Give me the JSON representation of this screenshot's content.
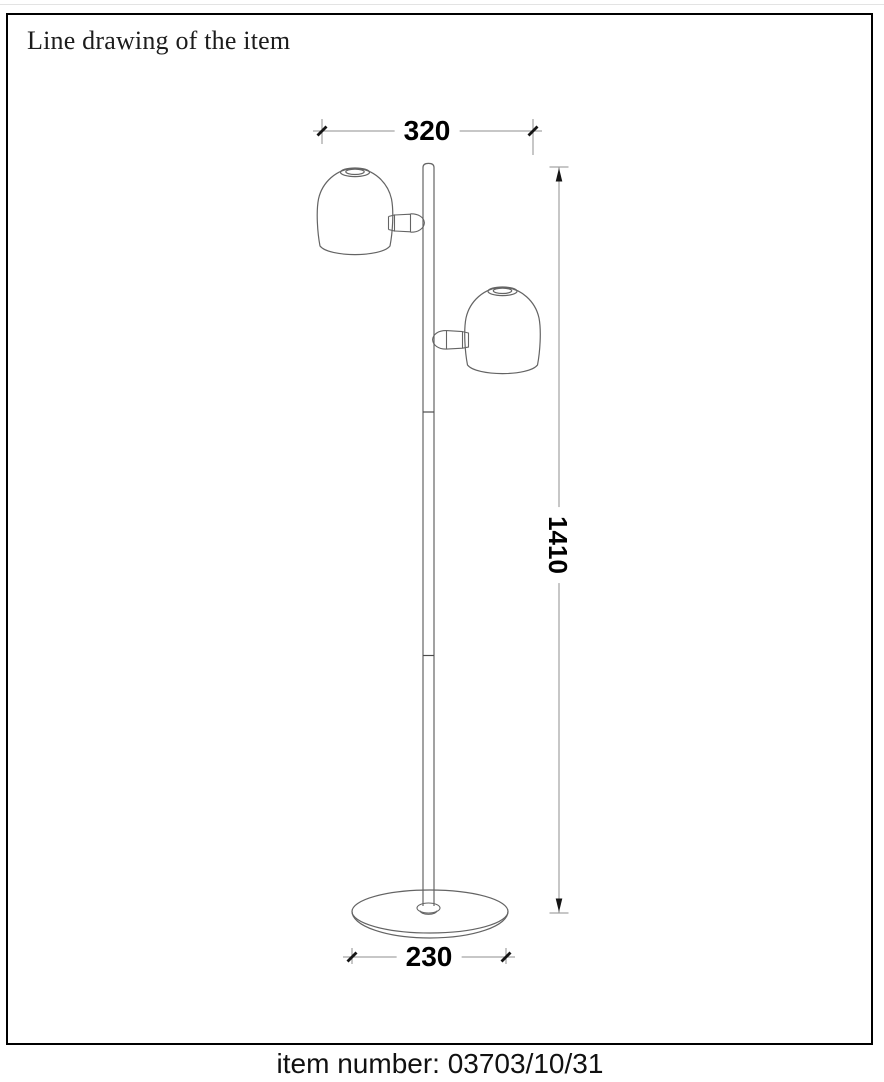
{
  "header": {
    "title": "Line drawing of the item"
  },
  "drawing": {
    "description": "technical line drawing of a floor lamp with two dome spot heads on a straight pole and a round base",
    "dimensions": {
      "width": "320",
      "height": "1410",
      "base_diameter": "230"
    }
  },
  "footer": {
    "item_number": "item number: 03703/10/31"
  },
  "colors": {
    "frame_border": "#000000",
    "object_line": "#646464",
    "dimension_line": "#8f8f8f",
    "tick_and_arrow": "#151515",
    "dimension_text": "#000000"
  }
}
